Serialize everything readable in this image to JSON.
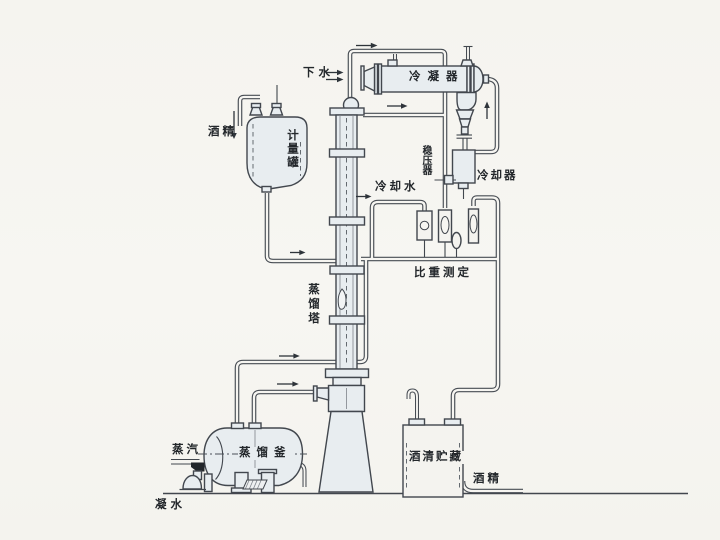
{
  "labels": {
    "drain_water": "下水",
    "condenser": "冷凝器",
    "alcohol_feed": "酒精",
    "metering_tank": "计量罐",
    "pressure_stabilizer": "稳压器",
    "cooling_water": "冷却水",
    "cooler": "冷却器",
    "specific_gravity_measurement": "比重测定",
    "distillation_tower": "蒸馏塔",
    "distillation_kettle": "蒸馏釜",
    "steam": "蒸汽",
    "alcohol_storage": "酒清贮藏",
    "alcohol_product": "酒精",
    "condensate": "凝水"
  },
  "colors": {
    "line": "#42474e",
    "vessel_fill": "#e8edf0",
    "paper": "#f6f5f1",
    "valve_fill": "#22262a"
  }
}
